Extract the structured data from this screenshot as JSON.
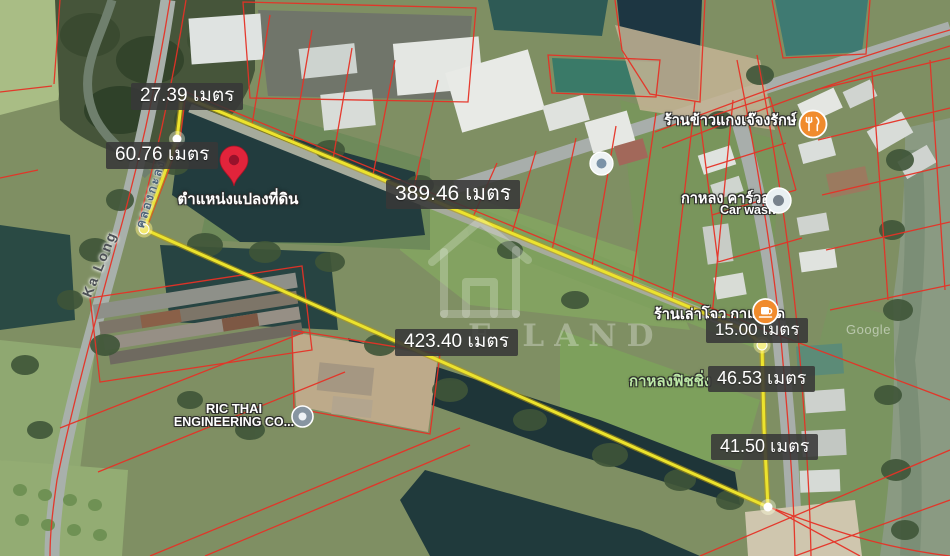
{
  "app": {
    "view": "satellite-map-land-plot",
    "unit_word": "เมตร"
  },
  "plot": {
    "pin_label": "ตำแหน่งแปลงที่ดิน",
    "outline_color": "#ece32d",
    "cadastral_color": "#e63226",
    "pin_color": "#e2243b",
    "measurements": [
      {
        "side": "northwest-top",
        "label": "27.39 เมตร"
      },
      {
        "side": "west",
        "label": "60.76 เมตร"
      },
      {
        "side": "north",
        "label": "389.46 เมตร"
      },
      {
        "side": "south",
        "label": "423.40 เมตร"
      },
      {
        "side": "east-jog",
        "label": "15.00 เมตร"
      },
      {
        "side": "east-upper",
        "label": "46.53 เมตร"
      },
      {
        "side": "east-lower",
        "label": "41.50 เมตร"
      }
    ]
  },
  "pois": [
    {
      "id": "restaurant",
      "label": "ร้านข้าวแกงเจ๊จงรักษ์",
      "icon": "restaurant-icon",
      "color": "#f08b2d"
    },
    {
      "id": "car-wash",
      "label": "กาหลง คาร์วอช",
      "sublabel": "Car wash",
      "icon": "car-wash-icon",
      "color": "#77828c"
    },
    {
      "id": "coffee-shop",
      "label": "ร้านเล่าโจว กาแฟสด",
      "icon": "coffee-icon",
      "color": "#f08b2d"
    },
    {
      "id": "fishing",
      "label": "กาหลงฟิชชิ่ง",
      "color": "#bce8a6"
    },
    {
      "id": "company",
      "label": "RIC THAI",
      "label2": "ENGINEERING CO...",
      "icon": "business-icon",
      "color": "#8795a1"
    }
  ],
  "road_labels": [
    {
      "id": "road",
      "label": "Ka Long"
    },
    {
      "id": "canal",
      "label": "คลองกะลง"
    }
  ],
  "watermark": {
    "text": "E LAND"
  },
  "attribution": {
    "text": "Google"
  }
}
